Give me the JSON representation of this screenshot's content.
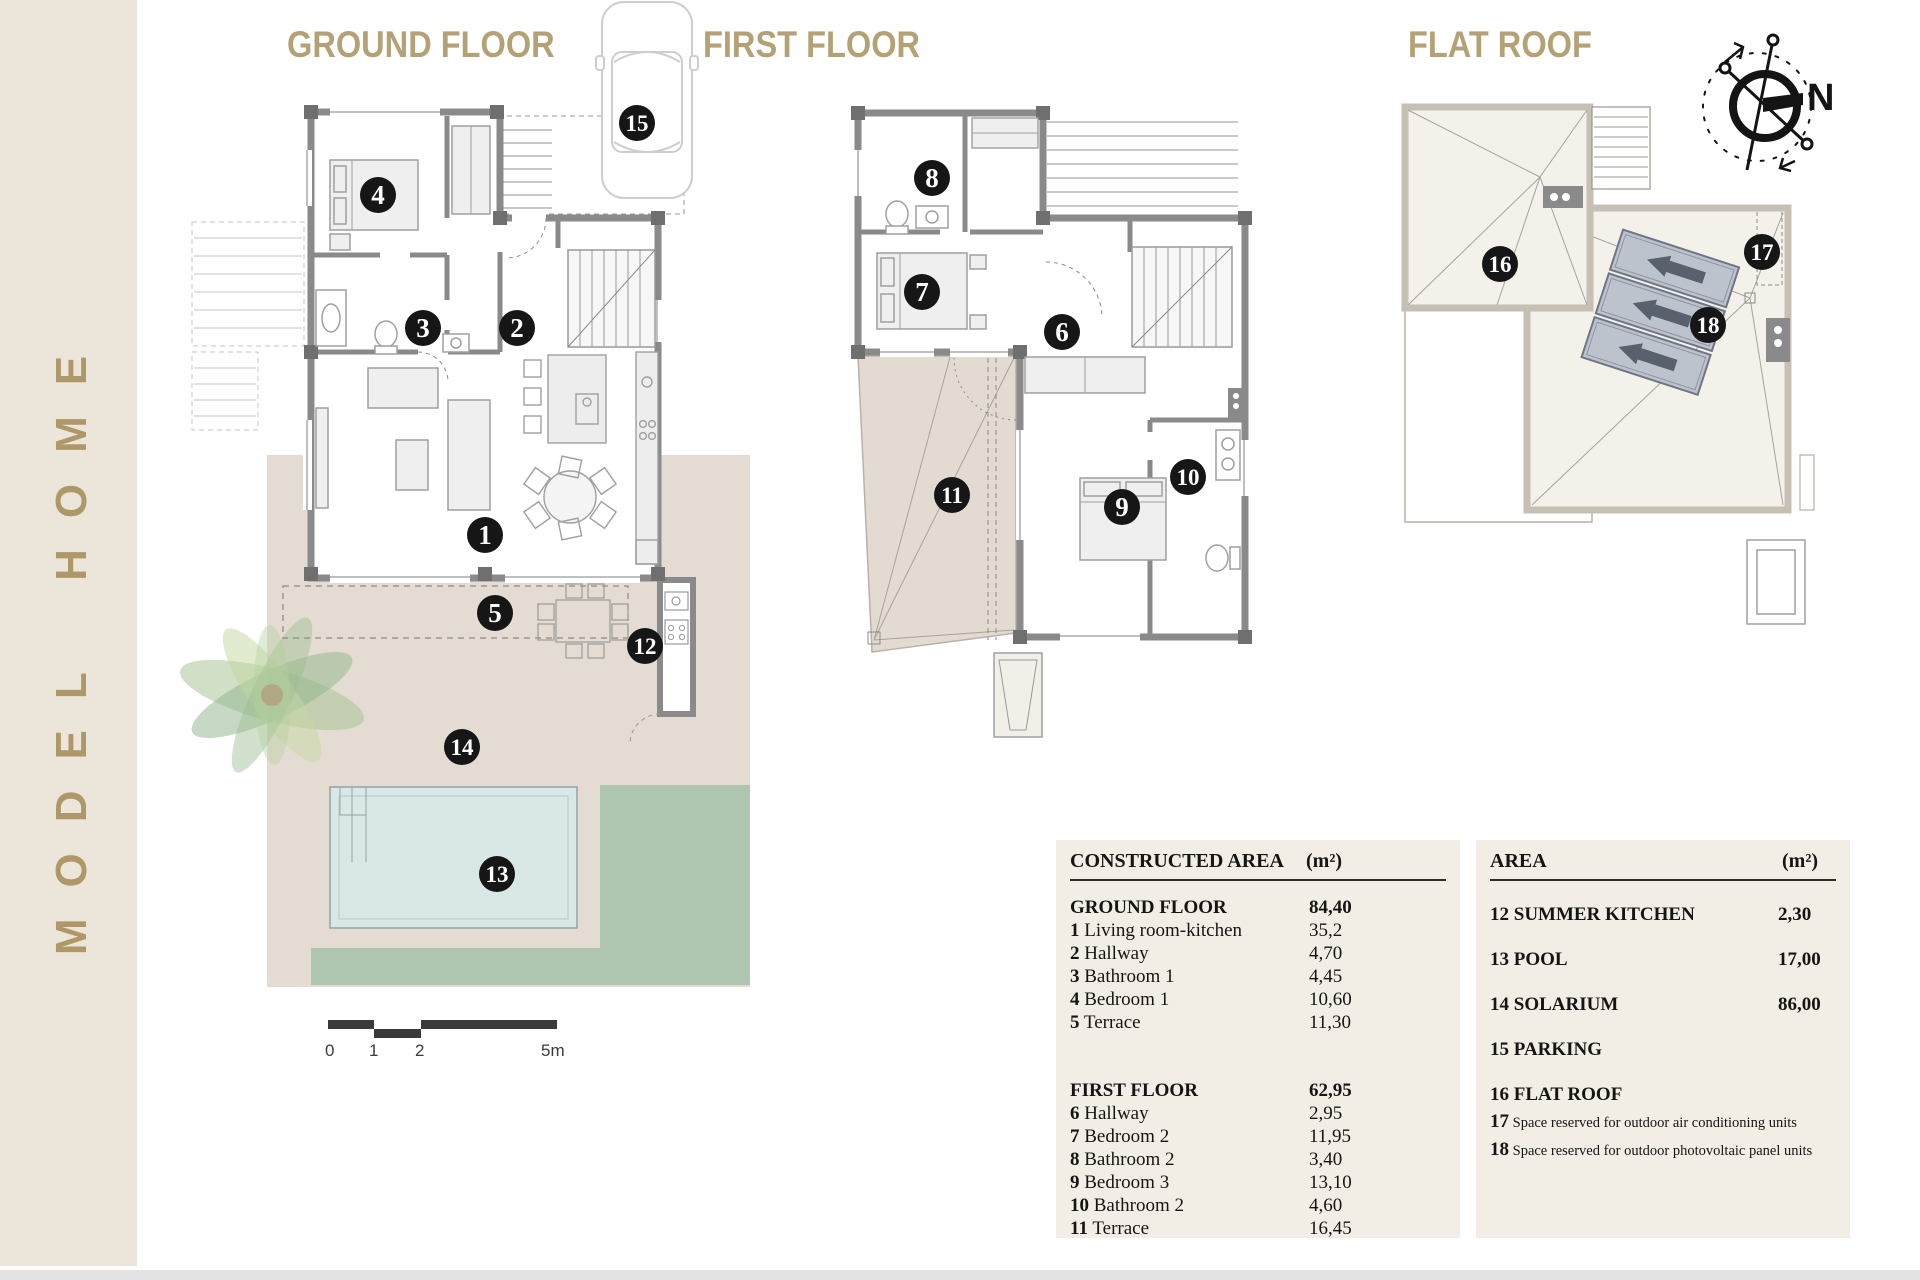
{
  "sidebar": {
    "title": "MODEL HOME"
  },
  "sections": {
    "ground": "GROUND FLOOR",
    "first": "FIRST FLOOR",
    "roof": "FLAT ROOF"
  },
  "compass": {
    "label": "N"
  },
  "scale": {
    "labels": [
      "0",
      "1",
      "2",
      "5m"
    ]
  },
  "markers": {
    "ground": [
      "4",
      "3",
      "2",
      "1",
      "5",
      "12",
      "14",
      "13",
      "15"
    ],
    "first": [
      "8",
      "7",
      "6",
      "11",
      "9",
      "10"
    ],
    "roof": [
      "16",
      "17",
      "18"
    ]
  },
  "tables": {
    "constructed": {
      "header": {
        "label": "CONSTRUCTED AREA",
        "unit": "(m²)"
      },
      "groups": [
        {
          "label": "GROUND FLOOR",
          "value": "84,40",
          "rows": [
            {
              "num": "1",
              "label": "Living room-kitchen",
              "value": "35,2"
            },
            {
              "num": "2",
              "label": "Hallway",
              "value": "4,70"
            },
            {
              "num": "3",
              "label": "Bathroom 1",
              "value": "4,45"
            },
            {
              "num": "4",
              "label": "Bedroom 1",
              "value": "10,60"
            },
            {
              "num": "5",
              "label": "Terrace",
              "value": "11,30"
            }
          ]
        },
        {
          "label": "FIRST FLOOR",
          "value": "62,95",
          "rows": [
            {
              "num": "6",
              "label": "Hallway",
              "value": "2,95"
            },
            {
              "num": "7",
              "label": "Bedroom 2",
              "value": "11,95"
            },
            {
              "num": "8",
              "label": "Bathroom 2",
              "value": "3,40"
            },
            {
              "num": "9",
              "label": "Bedroom 3",
              "value": "13,10"
            },
            {
              "num": "10",
              "label": "Bathroom 2",
              "value": "4,60"
            },
            {
              "num": "11",
              "label": "Terrace",
              "value": "16,45"
            }
          ]
        }
      ]
    },
    "area": {
      "header": {
        "label": "AREA",
        "unit": "(m²)"
      },
      "rows": [
        {
          "num": "12",
          "label": "SUMMER KITCHEN",
          "value": "2,30"
        },
        {
          "num": "13",
          "label": "POOL",
          "value": "17,00"
        },
        {
          "num": "14",
          "label": "SOLARIUM",
          "value": "86,00"
        },
        {
          "num": "15",
          "label": "PARKING",
          "value": ""
        },
        {
          "num": "16",
          "label": "FLAT ROOF",
          "value": ""
        }
      ],
      "notes": [
        {
          "num": "17",
          "label": "Space reserved for outdoor air conditioning units"
        },
        {
          "num": "18",
          "label": "Space reserved for outdoor photovoltaic panel units"
        }
      ]
    }
  },
  "colors": {
    "accent_gold": "#ae9769",
    "sidebar_bg": "#ece5da",
    "table_bg": "#f2eee5",
    "wall_gray": "#8a8a8a",
    "terrace_beige": "#e4dcd2",
    "grass_green": "#aec6b0",
    "pool_blue": "#d9e7e6",
    "roof_fill": "#f4f1ea",
    "solar_panel": "#bdc3cd",
    "marker_black": "#161616"
  }
}
